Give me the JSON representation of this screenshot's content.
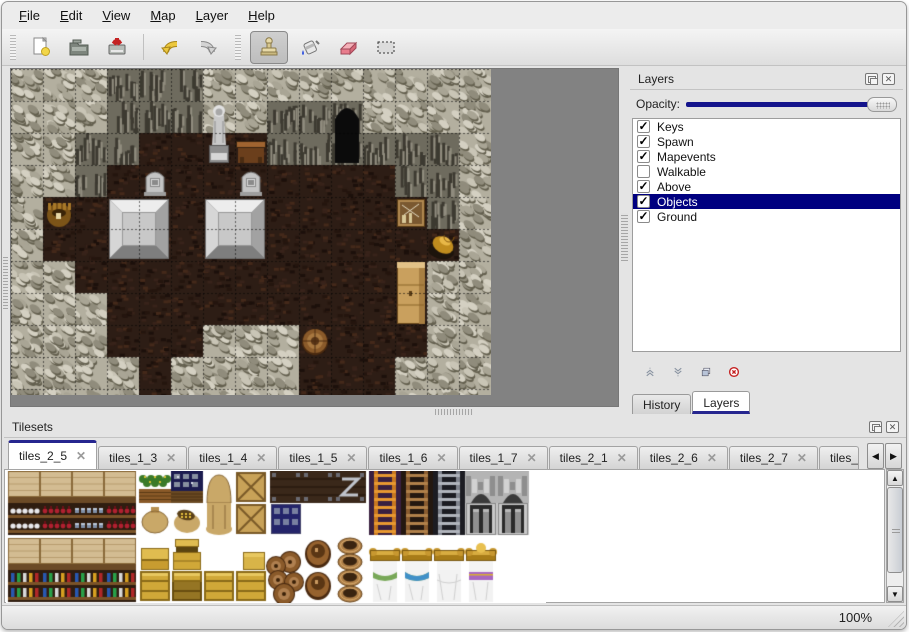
{
  "menu_bar": {
    "items": [
      {
        "label": "File",
        "mnemonic_index": 0
      },
      {
        "label": "Edit",
        "mnemonic_index": 0
      },
      {
        "label": "View",
        "mnemonic_index": 0
      },
      {
        "label": "Map",
        "mnemonic_index": 0
      },
      {
        "label": "Layer",
        "mnemonic_index": 0
      },
      {
        "label": "Help",
        "mnemonic_index": 0
      }
    ]
  },
  "toolbar": {
    "buttons": [
      {
        "icon": "new-file-icon",
        "active": false
      },
      {
        "icon": "open-icon",
        "active": false
      },
      {
        "icon": "save-icon",
        "active": false
      },
      {
        "icon": "undo-icon",
        "active": false
      },
      {
        "icon": "redo-icon",
        "active": false
      },
      {
        "icon": "stamp-tool-icon",
        "active": true
      },
      {
        "icon": "fill-tool-icon",
        "active": false
      },
      {
        "icon": "eraser-tool-icon",
        "active": false
      },
      {
        "icon": "select-tool-icon",
        "active": false
      }
    ]
  },
  "layers_panel": {
    "title": "Layers",
    "opacity_label": "Opacity:",
    "layers": [
      {
        "name": "Keys",
        "checked": true,
        "selected": false
      },
      {
        "name": "Spawn",
        "checked": true,
        "selected": false
      },
      {
        "name": "Mapevents",
        "checked": true,
        "selected": false
      },
      {
        "name": "Walkable",
        "checked": false,
        "selected": false
      },
      {
        "name": "Above",
        "checked": true,
        "selected": false
      },
      {
        "name": "Objects",
        "checked": true,
        "selected": true
      },
      {
        "name": "Ground",
        "checked": true,
        "selected": false
      }
    ],
    "bottom_tabs": [
      {
        "label": "History",
        "active": false
      },
      {
        "label": "Layers",
        "active": true
      }
    ]
  },
  "tilesets_panel": {
    "title": "Tilesets",
    "tabs": [
      {
        "label": "tiles_2_5",
        "active": true,
        "truncated": false
      },
      {
        "label": "tiles_1_3",
        "active": false,
        "truncated": false
      },
      {
        "label": "tiles_1_4",
        "active": false,
        "truncated": false
      },
      {
        "label": "tiles_1_5",
        "active": false,
        "truncated": false
      },
      {
        "label": "tiles_1_6",
        "active": false,
        "truncated": false
      },
      {
        "label": "tiles_1_7",
        "active": false,
        "truncated": false
      },
      {
        "label": "tiles_2_1",
        "active": false,
        "truncated": false
      },
      {
        "label": "tiles_2_6",
        "active": false,
        "truncated": false
      },
      {
        "label": "tiles_2_7",
        "active": false,
        "truncated": false
      },
      {
        "label": "tiles_",
        "active": false,
        "truncated": true
      }
    ],
    "scroll_left_icon": "◀",
    "scroll_right_icon": "▶"
  },
  "status_bar": {
    "zoom_level": "100%"
  },
  "colors": {
    "accent_navy": "#14148c",
    "selection_navy": "#000080",
    "tab_accent": "#26268f",
    "canvas_gray": "#828282"
  },
  "map": {
    "tile_size": 32,
    "grid": [
      "LLLDDDLLLLLLLLL",
      "LLLDDDLLDDDLLLL",
      "LLDDFFFFDDDDDDL",
      "LLDFFFFFFFFFDDL",
      "LFFFFFFFFFFFFDL",
      "LFFFFFFFFFFFFFL",
      "LLFFFFFFFFFFFLL",
      "LLLFFFFFFFFFFLL",
      "LLLFFFLLLFFFFLL",
      "LLLLFLLLLFFFLLL",
      "LLLLFLLLLFFFLLL"
    ],
    "objects": [
      {
        "type": "cave-entrance",
        "col": 10,
        "row": 1
      },
      {
        "type": "statue",
        "col": 6,
        "row": 1
      },
      {
        "type": "table",
        "col": 7,
        "row": 2
      },
      {
        "type": "gravestone",
        "col": 4,
        "row": 3
      },
      {
        "type": "gravestone",
        "col": 7,
        "row": 3
      },
      {
        "type": "stone-platform",
        "col": 3,
        "row": 4
      },
      {
        "type": "stone-platform",
        "col": 6,
        "row": 4
      },
      {
        "type": "pot",
        "col": 1,
        "row": 4
      },
      {
        "type": "tool-crate",
        "col": 12,
        "row": 4
      },
      {
        "type": "golden-horn",
        "col": 13,
        "row": 5
      },
      {
        "type": "cabinet",
        "col": 12,
        "row": 6
      },
      {
        "type": "barrel",
        "col": 9,
        "row": 8
      }
    ]
  },
  "tileset": {
    "tile_size": 32,
    "gap_after_cols": [
      3,
      7,
      10
    ],
    "rows": [
      [
        "shelf-top",
        "shelf-top",
        "shelf-top",
        "shelf-top",
        "plant-box",
        "ore-box",
        "sack-top",
        "crate-x",
        "dark-crate",
        "dark-crate",
        "dark-crate-z",
        "ladder-orange",
        "ladder-brown",
        "ladder-gray",
        "arch-top",
        "arch-top"
      ],
      [
        "shelf-dishes",
        "shelf-wine",
        "shelf-pots",
        "shelf-wine",
        "sack",
        "sack-open",
        "sack-bottom",
        "crate-x",
        "ore-crate",
        "empty",
        "empty",
        "ladder-orange",
        "ladder-brown",
        "ladder-gray",
        "arch-door",
        "arch-door"
      ],
      [
        "shelf-top",
        "shelf-top",
        "shelf-top",
        "shelf-top",
        "crate-gold-top",
        "crate-gold-tall",
        "empty",
        "crate-gold-small",
        "barrel-pile-top",
        "barrel-top",
        "pot-open",
        "bed-head",
        "bed-head",
        "bed-head",
        "bed-head-crest",
        "empty"
      ],
      [
        "shelf-books",
        "shelf-books",
        "shelf-books",
        "shelf-books",
        "crate-gold",
        "crate-gold-dark",
        "crate-gold",
        "crate-gold",
        "barrel-pile",
        "barrel-top",
        "pot-open",
        "bed-green",
        "bed-blue",
        "bed-white",
        "bed-purple",
        "empty"
      ]
    ]
  }
}
